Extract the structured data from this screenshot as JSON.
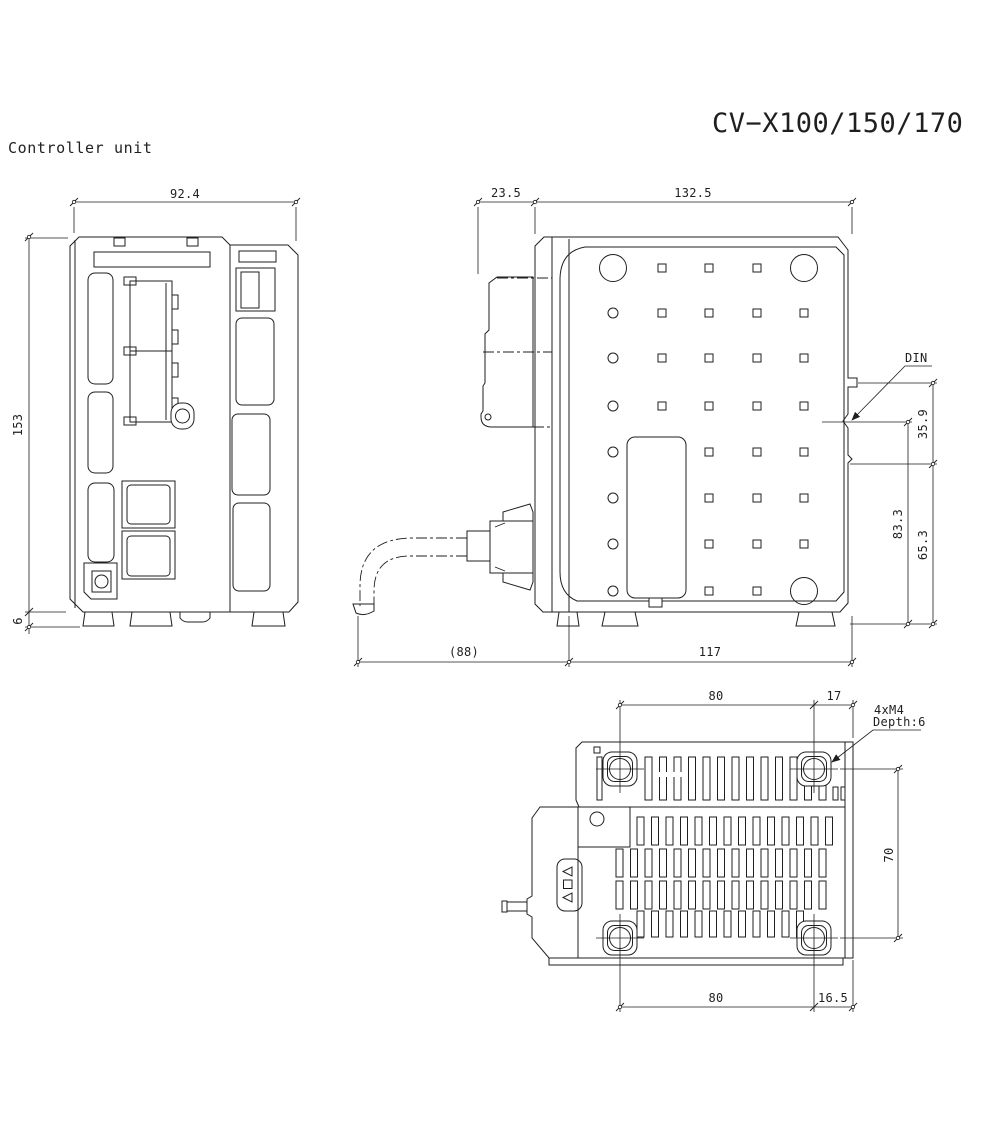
{
  "page": {
    "product_label": "Controller unit",
    "model_title": "CV−X100/150/170",
    "line_color": "#1f1f1f",
    "bg_color": "#ffffff"
  },
  "front_view": {
    "dim_width": "92.4",
    "dim_height": "153",
    "dim_foot_height": "6"
  },
  "side_view": {
    "dim_front_depth": "23.5",
    "dim_body_depth": "132.5",
    "dim_cable_clearance": "(88)",
    "dim_base_depth": "117",
    "din_label": "DIN",
    "dim_din_to_top": "35.9",
    "dim_din_span": "83.3",
    "dim_step_to_bottom": "65.3"
  },
  "bottom_view": {
    "dim_hole_pitch_top": "80",
    "dim_hole_edge_top": "17",
    "dim_hole_pitch_side": "70",
    "dim_hole_pitch_bottom": "80",
    "dim_hole_edge_bottom": "16.5",
    "screw_note_line1": "4xM4",
    "screw_note_line2": "Depth:6"
  }
}
